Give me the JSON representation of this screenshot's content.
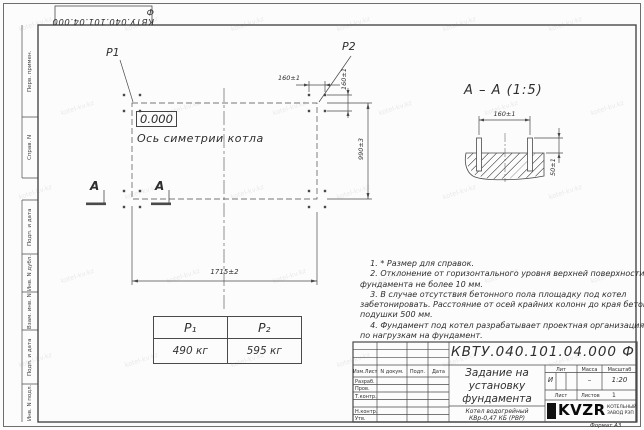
{
  "stamp": {
    "designation": "КВТУ.040.101.04.000 Ф"
  },
  "margin": {
    "fields": [
      "Перв. примен.",
      "Справ. N",
      "Подп. и дата",
      "Инв. N дубл.",
      "Взам. инв. N",
      "Подп. и дата",
      "Инв. N подл."
    ]
  },
  "plan": {
    "p1_label": "P1",
    "p2_label": "P2",
    "elevation": "0.000",
    "axis_label": "Ось симетрии котла",
    "section_letter": "А",
    "dim_bolt_spacing_x": "160±1",
    "dim_bolt_spacing_y": "160±1",
    "dim_height": "990±3",
    "dim_width": "1715±2"
  },
  "section": {
    "title": "А – А (1:5)",
    "dim_spacing": "160±1",
    "dim_protrusion": "50±1"
  },
  "load_table": {
    "headers": [
      "P₁",
      "P₂"
    ],
    "values": [
      "490 кг",
      "595 кг"
    ]
  },
  "notes": {
    "lines": [
      "    1. * Размер для справок.",
      "    2. Отклонение от горизонтального уровня верхней поверхности",
      "фундамента не более 10 мм.",
      "    3. В случае отсутствия бетонного пола площадку под котел",
      "забетонировать. Расстояние от осей крайних колонн до края бетонной",
      "подушки 500 мм.",
      "    4. Фундамент под котел разрабатывает проектная организация",
      "по нагрузкам на фундамент."
    ]
  },
  "title_block": {
    "designation": "КВТУ.040.101.04.000 Ф",
    "doc_title_lines": [
      "Задание на",
      "установку",
      "фундамента"
    ],
    "product_lines": [
      "Котел водогрейный",
      "КВр-0,47 КБ (РВР)"
    ],
    "header_cols": [
      "Изм.Лист",
      "N докум.",
      "Подп.",
      "Дата"
    ],
    "sign_rows": [
      "Разраб.",
      "Пров.",
      "Т.контр.",
      "Н.контр.",
      "Утв."
    ],
    "lit_label": "Лит",
    "mass_label": "Масса",
    "scale_label": "Масштаб",
    "lit_value": "И",
    "mass_value": "–",
    "scale_value": "1:20",
    "sheet_label": "Лист",
    "sheets_label": "Листов",
    "sheets_value": "1",
    "logo_text": "KVZR",
    "logo_sub_lines": [
      "КОТЕЛЬНЫЙ",
      "ЗАВОД РЭП"
    ],
    "format_label": "Формат А3"
  },
  "watermark": {
    "text": "kotel-kv.kz"
  },
  "line_colors": {
    "main": "#4a4a4a",
    "text": "#2e2e2e"
  }
}
